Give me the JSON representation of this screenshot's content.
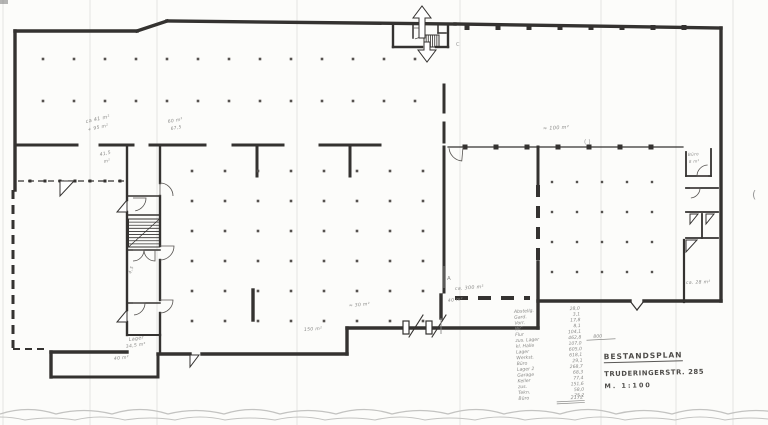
{
  "document": {
    "kind": "scanned architectural floor plan, ground floor, black ink on white paper with pencil notes"
  },
  "palette": {
    "paper": "#fcfcfa",
    "ink": "#343230",
    "ink_light": "#55524f",
    "pencil": "#8a8a88",
    "pen": "#4e4c49",
    "scallop": "#c3c3c1",
    "fold": "rgba(40,40,40,0.055)"
  },
  "title_block": {
    "line1": "BESTANDSPLAN",
    "line2": "TRUDERINGERSTR. 285",
    "line3": "M. 1:100"
  },
  "plan": {
    "walls": [
      [
        15,
        31,
        15,
        190,
        3.4
      ],
      [
        15,
        31,
        137,
        31,
        3.4
      ],
      [
        137,
        31,
        167,
        21,
        3.4
      ],
      [
        167,
        21,
        455,
        24,
        3.4
      ],
      [
        455,
        24,
        721,
        28,
        3.4
      ],
      [
        721,
        28,
        721,
        301,
        3.4
      ],
      [
        721,
        301,
        644,
        301,
        3.4
      ],
      [
        630,
        301,
        538,
        301,
        3.4
      ],
      [
        538,
        262,
        538,
        328,
        3.4
      ],
      [
        538,
        328,
        347,
        328,
        3.4
      ],
      [
        347,
        328,
        347,
        354,
        3.4
      ],
      [
        347,
        354,
        202,
        354,
        3.4
      ],
      [
        190,
        354,
        158,
        354,
        3.4
      ],
      [
        158,
        354,
        158,
        377,
        3.0
      ],
      [
        158,
        377,
        51,
        377,
        3.0
      ],
      [
        51,
        377,
        51,
        352,
        3.4
      ],
      [
        51,
        352,
        127,
        352,
        3.4
      ],
      [
        15,
        145,
        77,
        145,
        3.0
      ],
      [
        100,
        145,
        133,
        145,
        3.0
      ],
      [
        150,
        145,
        205,
        145,
        3.0
      ],
      [
        233,
        145,
        283,
        145,
        3.0
      ],
      [
        320,
        145,
        380,
        145,
        3.0
      ],
      [
        257,
        145,
        257,
        176,
        3.0
      ],
      [
        350,
        145,
        350,
        176,
        3.0
      ],
      [
        444,
        85,
        444,
        112,
        3.0
      ],
      [
        444,
        123,
        444,
        142,
        3.0
      ],
      [
        444,
        147,
        444,
        292,
        3.0
      ],
      [
        441,
        295,
        441,
        318,
        3.4
      ],
      [
        253,
        290,
        253,
        320,
        3.4
      ],
      [
        538,
        147,
        538,
        185,
        3.0
      ],
      [
        160,
        335,
        160,
        354,
        2.4
      ],
      [
        127,
        335,
        160,
        335,
        2.0
      ],
      [
        127,
        145,
        127,
        200,
        2.4
      ],
      [
        127,
        212,
        127,
        310,
        2.4
      ],
      [
        127,
        322,
        127,
        335,
        2.4
      ],
      [
        160,
        145,
        160,
        183,
        2.4
      ],
      [
        160,
        196,
        160,
        246,
        2.4
      ],
      [
        160,
        260,
        160,
        300,
        2.4
      ],
      [
        160,
        313,
        160,
        335,
        2.4
      ],
      [
        127,
        196,
        160,
        196,
        1.5
      ],
      [
        127,
        215,
        160,
        215,
        1.5
      ],
      [
        127,
        250,
        160,
        250,
        1.5
      ],
      [
        127,
        303,
        160,
        303,
        1.5
      ],
      [
        686,
        152,
        686,
        176,
        1.8
      ],
      [
        686,
        176,
        711,
        176,
        1.8
      ],
      [
        711,
        149,
        711,
        176,
        1.8
      ],
      [
        686,
        188,
        718,
        188,
        1.8
      ],
      [
        686,
        212,
        718,
        212,
        1.8
      ],
      [
        702,
        214,
        702,
        238,
        1.8
      ],
      [
        686,
        238,
        718,
        238,
        1.8
      ],
      [
        684,
        240,
        684,
        302,
        2.2
      ],
      [
        393,
        24,
        393,
        47,
        2.4
      ],
      [
        393,
        47,
        422,
        47,
        2.4
      ],
      [
        436,
        47,
        448,
        47,
        2.4
      ],
      [
        448,
        24,
        448,
        47,
        2.4
      ],
      [
        413,
        24,
        413,
        38,
        1.5
      ],
      [
        438,
        26,
        438,
        33,
        1.5
      ],
      [
        438,
        33,
        446,
        33,
        1.5
      ],
      [
        448,
        147,
        683,
        147,
        1.2
      ],
      [
        630,
        301,
        637,
        310,
        1.2
      ],
      [
        637,
        310,
        644,
        301,
        1.2
      ],
      [
        409,
        337,
        423,
        315,
        1.1
      ],
      [
        432,
        337,
        446,
        315,
        1.1
      ]
    ],
    "dashed_walls": [
      [
        13,
        190,
        13,
        348,
        3.0,
        "9,6"
      ],
      [
        18,
        181,
        127,
        181,
        1.3,
        "6,4"
      ],
      [
        538,
        185,
        538,
        262,
        4.0,
        "12,9"
      ],
      [
        455,
        298,
        530,
        298,
        4.0,
        "13,10"
      ],
      [
        13,
        349,
        49,
        349,
        2.0,
        "7,5"
      ]
    ],
    "dot_grids": [
      {
        "x0": 43,
        "y0": 59,
        "dx": 31,
        "dy": 42,
        "cols": 13,
        "rows": 2,
        "s": 2.6
      },
      {
        "x0": 192,
        "y0": 171,
        "dx": 33,
        "dy": 30,
        "cols": 8,
        "rows": 6,
        "s": 2.6
      },
      {
        "x0": 552,
        "y0": 182,
        "dx": 25,
        "dy": 30,
        "cols": 5,
        "rows": 4,
        "s": 2.4
      }
    ],
    "piers": [
      {
        "y": 27.5,
        "xs": [
          467,
          498,
          529,
          560,
          591,
          622,
          653,
          684
        ],
        "s": 5
      },
      {
        "y": 147,
        "xs": [
          465,
          496,
          527,
          558,
          589,
          620,
          651
        ],
        "s": 5
      },
      {
        "y": 181,
        "xs": [
          30,
          45,
          60,
          75,
          90,
          105,
          120
        ],
        "s": 3
      }
    ],
    "stairs": [
      {
        "x": 128.5,
        "y": 219,
        "w": 31,
        "h": 28,
        "n": 8,
        "dir": "h",
        "diag": true
      },
      {
        "x": 424,
        "y": 35,
        "w": 15,
        "h": 12,
        "n": 6,
        "dir": "v",
        "diag": false
      }
    ],
    "door_arcs": [
      [
        133,
        198,
        13,
        0,
        80
      ],
      [
        160,
        196,
        13,
        -90,
        0
      ],
      [
        160,
        246,
        14,
        0,
        90
      ],
      [
        160,
        300,
        13,
        0,
        90
      ],
      [
        133,
        250,
        11,
        0,
        90
      ],
      [
        155,
        250,
        11,
        90,
        180
      ],
      [
        133,
        303,
        12,
        0,
        85
      ],
      [
        413,
        28,
        11,
        0,
        80
      ],
      [
        463,
        147,
        14,
        95,
        175
      ],
      [
        708,
        176,
        11,
        180,
        268
      ],
      [
        690,
        188,
        10,
        0,
        85
      ]
    ],
    "door_leaves": [
      [
        [
          60,
          181
        ],
        [
          74,
          181
        ],
        [
          60,
          196
        ]
      ],
      [
        [
          127,
          200
        ],
        [
          127,
          212
        ],
        [
          117,
          212
        ]
      ],
      [
        [
          127,
          310
        ],
        [
          127,
          322
        ],
        [
          117,
          322
        ]
      ],
      [
        [
          190,
          355
        ],
        [
          199,
          355
        ],
        [
          190,
          367
        ]
      ],
      [
        [
          686,
          240
        ],
        [
          697,
          240
        ],
        [
          686,
          252
        ]
      ],
      [
        [
          690,
          214
        ],
        [
          698,
          214
        ],
        [
          690,
          224
        ]
      ],
      [
        [
          706,
          214
        ],
        [
          714,
          214
        ],
        [
          706,
          224
        ]
      ]
    ],
    "door_jambs": [
      [
        403,
        321,
        6,
        13
      ],
      [
        426,
        321,
        6,
        13
      ]
    ],
    "arrows": [
      [
        [
          419,
          38
        ],
        [
          419,
          18
        ],
        [
          413,
          18
        ],
        [
          422,
          6
        ],
        [
          431,
          18
        ],
        [
          425,
          18
        ],
        [
          425,
          38
        ]
      ],
      [
        [
          424,
          42
        ],
        [
          424,
          50
        ],
        [
          418,
          50
        ],
        [
          427,
          62
        ],
        [
          436,
          50
        ],
        [
          430,
          50
        ],
        [
          430,
          42
        ]
      ]
    ],
    "section_marks": [
      {
        "line": [
          444,
          266,
          444,
          288
        ],
        "label": "A",
        "lx": 447,
        "ly": 280
      },
      {
        "line": [
          441,
          318,
          441,
          334
        ],
        "label": "",
        "lx": 0,
        "ly": 0
      }
    ],
    "annotations": [
      {
        "x": 86,
        "y": 123,
        "t": "ca 41 m²",
        "s": 5,
        "r": -12
      },
      {
        "x": 88,
        "y": 131,
        "t": "+ 95 m²",
        "s": 4.6,
        "r": -12
      },
      {
        "x": 168,
        "y": 123,
        "t": "60 m²",
        "s": 4.6,
        "r": -10
      },
      {
        "x": 171,
        "y": 130,
        "t": "67,5",
        "s": 4.4,
        "r": -10
      },
      {
        "x": 100,
        "y": 156,
        "t": "41,5",
        "s": 4.6,
        "r": -12
      },
      {
        "x": 104,
        "y": 163,
        "t": "m²",
        "s": 4.4,
        "r": -12
      },
      {
        "x": 543,
        "y": 130,
        "t": "≈ 100 m²",
        "s": 5,
        "r": -3
      },
      {
        "x": 455,
        "y": 290,
        "t": "ca. 300 m²",
        "s": 4.8,
        "r": -4
      },
      {
        "x": 448,
        "y": 302,
        "t": "40 m²",
        "s": 4.6,
        "r": -6
      },
      {
        "x": 349,
        "y": 307,
        "t": "≈ 30 m²",
        "s": 4.6,
        "r": -5
      },
      {
        "x": 304,
        "y": 331,
        "t": "150 m²",
        "s": 4.6,
        "r": -4
      },
      {
        "x": 129,
        "y": 341,
        "t": "Lager",
        "s": 4.8,
        "r": -8
      },
      {
        "x": 126,
        "y": 348,
        "t": "34,5 m²",
        "s": 4.6,
        "r": -8
      },
      {
        "x": 114,
        "y": 360,
        "t": "40 m²",
        "s": 4.6,
        "r": -6
      },
      {
        "x": 131,
        "y": 274,
        "t": "4,5",
        "s": 4.4,
        "r": -70
      },
      {
        "x": 686,
        "y": 284,
        "t": "ca. 28 m²",
        "s": 4.6,
        "r": -2
      },
      {
        "x": 688,
        "y": 156,
        "t": "Büro",
        "s": 4.2,
        "r": -4
      },
      {
        "x": 689,
        "y": 163,
        "t": "8 m²",
        "s": 4.0,
        "r": -4
      }
    ],
    "schedule": {
      "x": 514,
      "y0": 313,
      "lh": 5.8,
      "vx": 580,
      "rot": -3,
      "fs": 4.6,
      "rows": [
        {
          "name": "Abstellg.",
          "value": "28,0"
        },
        {
          "name": "Gard.",
          "value": "3,1"
        },
        {
          "name": "Vorr.",
          "value": "17,8"
        },
        {
          "name": "WC",
          "value": "8,1"
        },
        {
          "name": "Flur",
          "value": "104,1"
        },
        {
          "name": "zus. Lager",
          "value": "462,8"
        },
        {
          "name": "kl. Halle",
          "value": "107,0"
        },
        {
          "name": "Lager",
          "value": "605,0"
        },
        {
          "name": "Werkst.",
          "value": "618,1"
        },
        {
          "name": "Büro",
          "value": "29,1"
        },
        {
          "name": "Lager 2",
          "value": "268,7"
        },
        {
          "name": "Garage",
          "value": "68,3"
        },
        {
          "name": "Keller",
          "value": "77,4"
        },
        {
          "name": "zus.",
          "value": "151,6"
        },
        {
          "name": "Tekn.",
          "value": "58,0"
        },
        {
          "name": "Büro",
          "value": "75,2"
        }
      ],
      "side_note": {
        "t": "800",
        "x": 592,
        "y": 342,
        "ul": [
          585,
          344,
          614,
          344
        ]
      },
      "total": {
        "t": "2172",
        "x": 566,
        "y": 402,
        "ul1": [
          552,
          404,
          580,
          404
        ],
        "ul2": [
          552,
          406,
          580,
          406
        ]
      }
    },
    "artifacts": {
      "folds": [
        3,
        90,
        157,
        297,
        460,
        601,
        676,
        733
      ],
      "glyphs": [
        {
          "x": 752,
          "y": 198,
          "t": "(",
          "s": 11
        },
        {
          "x": 584,
          "y": 144,
          "t": "( )",
          "s": 6
        },
        {
          "x": 456,
          "y": 46,
          "t": "C",
          "s": 5
        }
      ],
      "speck": [
        0,
        0,
        8,
        4
      ],
      "scallops": [
        {
          "y": 414,
          "amp": 9,
          "step": 56,
          "n": 14,
          "off": 0,
          "w": 1.3
        },
        {
          "y": 420,
          "amp": 6,
          "step": 50,
          "n": 16,
          "off": -25,
          "w": 1.0
        }
      ]
    }
  }
}
